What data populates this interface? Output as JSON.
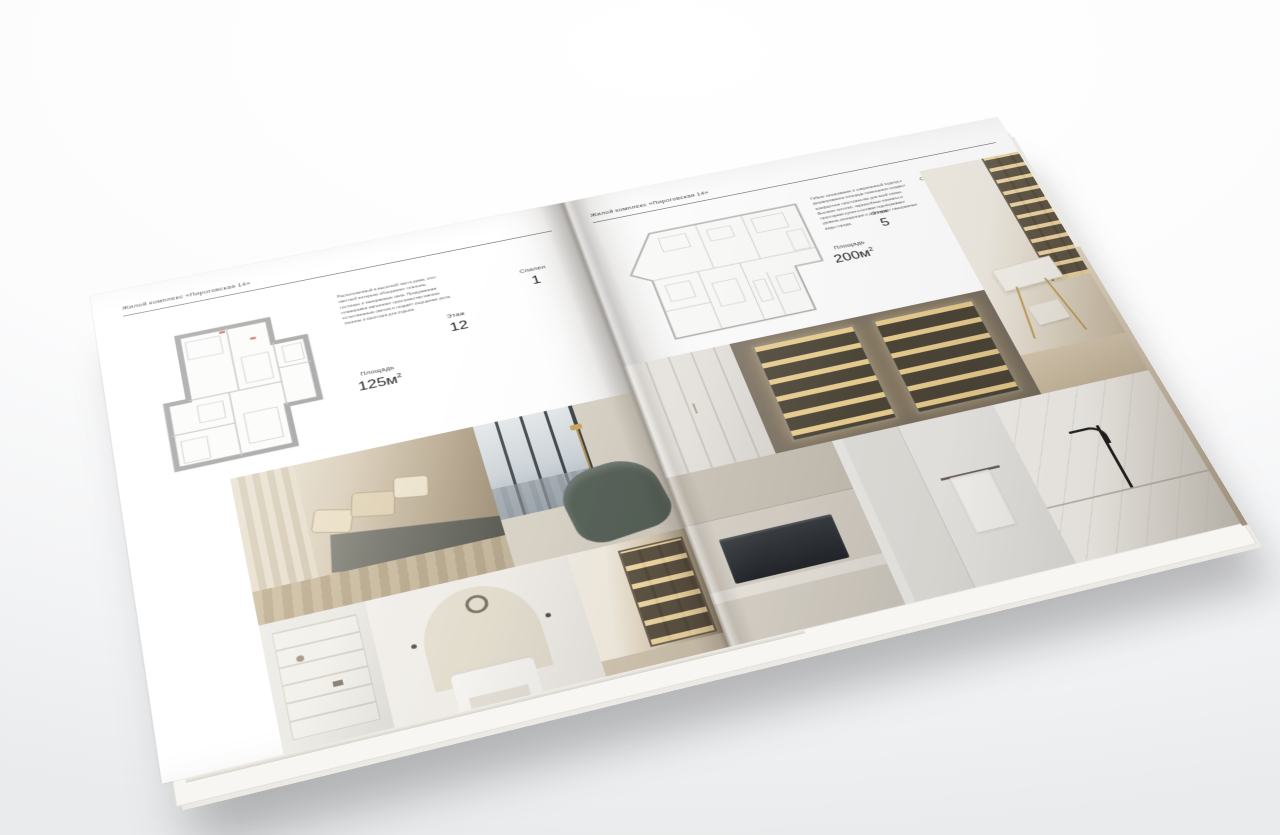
{
  "palette": {
    "page_bg": "#ffffff",
    "backdrop": "#f2f3f4",
    "ink": "#3c3c3c",
    "rule": "#6d6d6d",
    "shelf_glow": "#ecd091",
    "plan_wall": "#a9a9a9"
  },
  "left_page": {
    "header": "Жилой комплекс «Пироговская 14»",
    "description": "Расположенный в высотной части дома, этот светлый интерьер объединяет спальню, гостиную и панорамные окна. Продуманная планировка наполняет пространство мягким естественным светом и создаёт ощущение уюта, тишины и простора для отдыха.",
    "specs": {
      "area_label": "Площадь",
      "area_value": "125м",
      "area_sup": "2",
      "floor_label": "Этаж",
      "floor_value": "12",
      "bedrooms_label": "Спален",
      "bedrooms_value": "1"
    }
  },
  "right_page": {
    "header": "Жилой комплекс «Пироговская 14»",
    "description": "Гибкое зонирование и современный подход к формированию площади помещения создают комфортное пространство для всей семьи. Высокие потолки, гардеробные комнаты и просторная кухня-столовая подчёркивают уровень резиденции и дополняют панорамные виды города.",
    "specs": {
      "area_label": "Площадь",
      "area_value": "200м",
      "area_sup": "2",
      "floor_label": "Этаж",
      "floor_value": "5",
      "bedrooms_label": "Спален",
      "bedrooms_value": "2"
    }
  }
}
